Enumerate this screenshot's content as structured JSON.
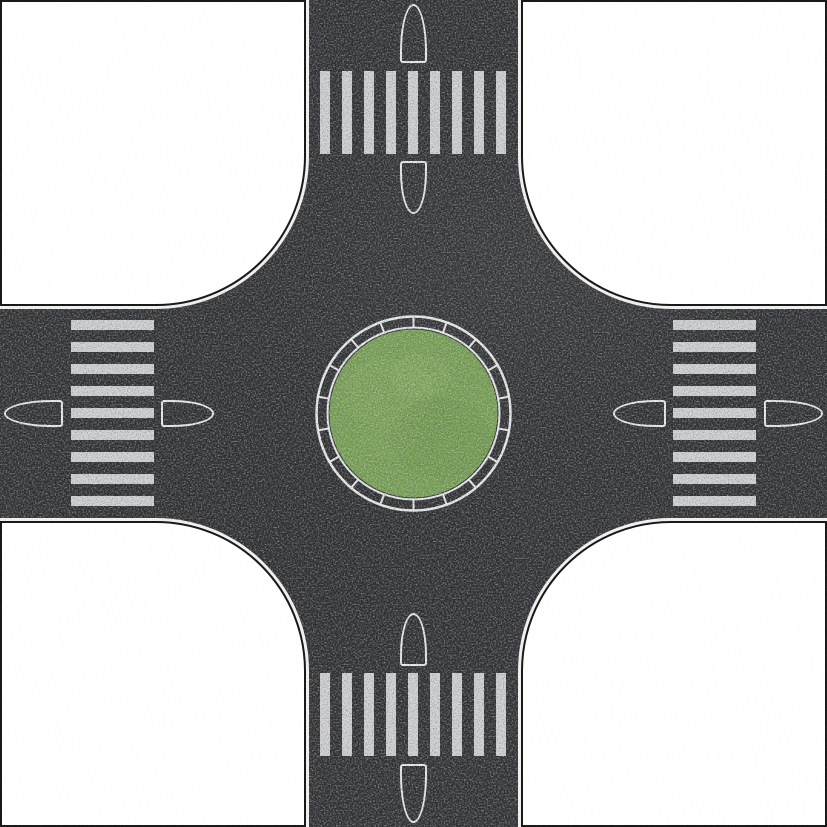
{
  "scene": {
    "description": "Top-down model road plate: four-way cross intersection with a central grass roundabout, zebra crossings and split bullet traffic islands on all four arms, white corner fields with black boundary and white road edge lines",
    "canvas": {
      "width_px": 827,
      "height_px": 827
    }
  },
  "colors": {
    "field_white": "#ffffff",
    "asphalt": "#2d2f31",
    "marking_white": "#efefef",
    "zebra_stripe": "#d2d3d4",
    "edge_black": "#161616",
    "grass_green": "#78a254"
  },
  "road": {
    "arms": 4,
    "surface": "asphalt",
    "edge_marking": "thin white line inside black boundary",
    "corner_fillet_radius_px": 150
  },
  "roundabout": {
    "center_island": "grass",
    "green_radius_px": 84,
    "ring_inner_radius_px": 86,
    "ring_outer_radius_px": 97,
    "ring_segments": 18
  },
  "crosswalks": [
    {
      "id": "north",
      "stripe_count": 9
    },
    {
      "id": "east",
      "stripe_count": 9
    },
    {
      "id": "south",
      "stripe_count": 9
    },
    {
      "id": "west",
      "stripe_count": 9
    }
  ],
  "islands": [
    {
      "id": "north-outer",
      "shape": "bullet",
      "nose": "up"
    },
    {
      "id": "north-inner",
      "shape": "bullet",
      "nose": "down"
    },
    {
      "id": "east-inner",
      "shape": "bullet",
      "nose": "left"
    },
    {
      "id": "east-outer",
      "shape": "bullet",
      "nose": "right"
    },
    {
      "id": "south-inner",
      "shape": "bullet",
      "nose": "up"
    },
    {
      "id": "south-outer",
      "shape": "bullet",
      "nose": "down"
    },
    {
      "id": "west-outer",
      "shape": "bullet",
      "nose": "left"
    },
    {
      "id": "west-inner",
      "shape": "bullet",
      "nose": "right"
    }
  ],
  "corners": [
    {
      "id": "top-left"
    },
    {
      "id": "top-right"
    },
    {
      "id": "bottom-left"
    },
    {
      "id": "bottom-right"
    }
  ]
}
